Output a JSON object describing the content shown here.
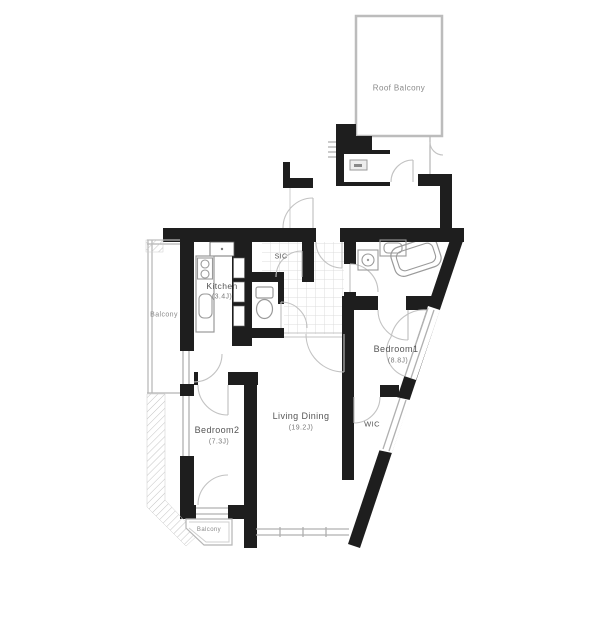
{
  "plan": {
    "type": "apartment-floor-plan",
    "rooms": {
      "roof_balcony": {
        "label": "Roof Balcony"
      },
      "balcony_left": {
        "label": "Balcony"
      },
      "kitchen": {
        "label": "Kitchen",
        "size": "(3.4J)"
      },
      "sic": {
        "label": "SIC"
      },
      "bedroom1": {
        "label": "Bedroom1",
        "size": "(8.8J)"
      },
      "living_dining": {
        "label": "Living Dining",
        "size": "(19.2J)"
      },
      "wic": {
        "label": "WIC"
      },
      "bedroom2": {
        "label": "Bedroom2",
        "size": "(7.3J)"
      },
      "balcony_bottom": {
        "label": "Balcony"
      }
    },
    "colors": {
      "wall": "#1e1e1e",
      "background": "#ffffff",
      "balcony_outline": "#b5b5b5",
      "fixture": "#9a9a9a",
      "tile_line": "#dcdcdc",
      "label": "#555555"
    }
  }
}
